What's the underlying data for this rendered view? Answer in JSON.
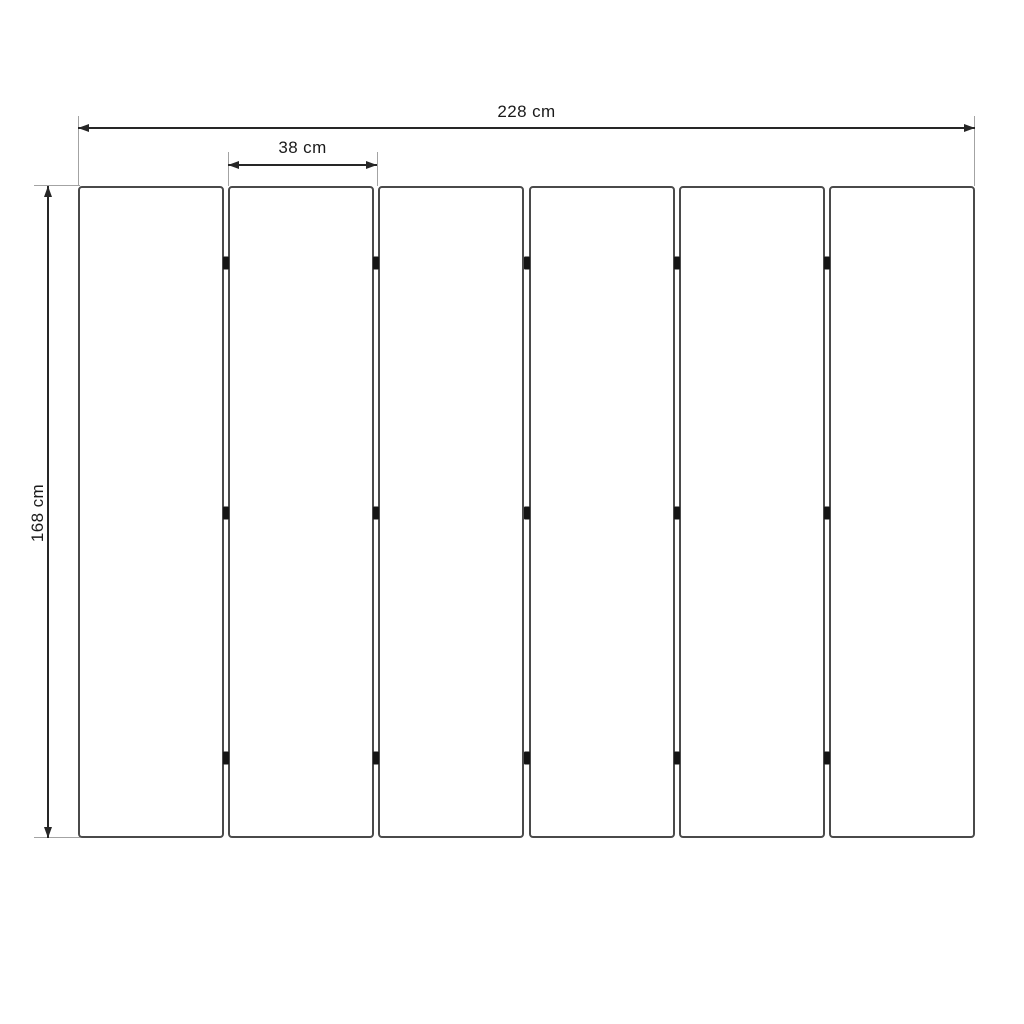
{
  "diagram": {
    "description": "Dimensioned line drawing of six vertical panels joined by hinge marks",
    "dimensions": {
      "total_width_label": "228 cm",
      "panel_width_label": "38 cm",
      "height_label": "168 cm"
    },
    "panels": {
      "count": 6,
      "gaps": 5,
      "hinges_per_gap": 3
    },
    "colors": {
      "background": "#ffffff",
      "panel_border": "#4a4a4a",
      "dimension_line": "#262626",
      "extension_line": "#a3a3a3",
      "hinge": "#141414",
      "label_text": "#1a1a1a"
    }
  }
}
